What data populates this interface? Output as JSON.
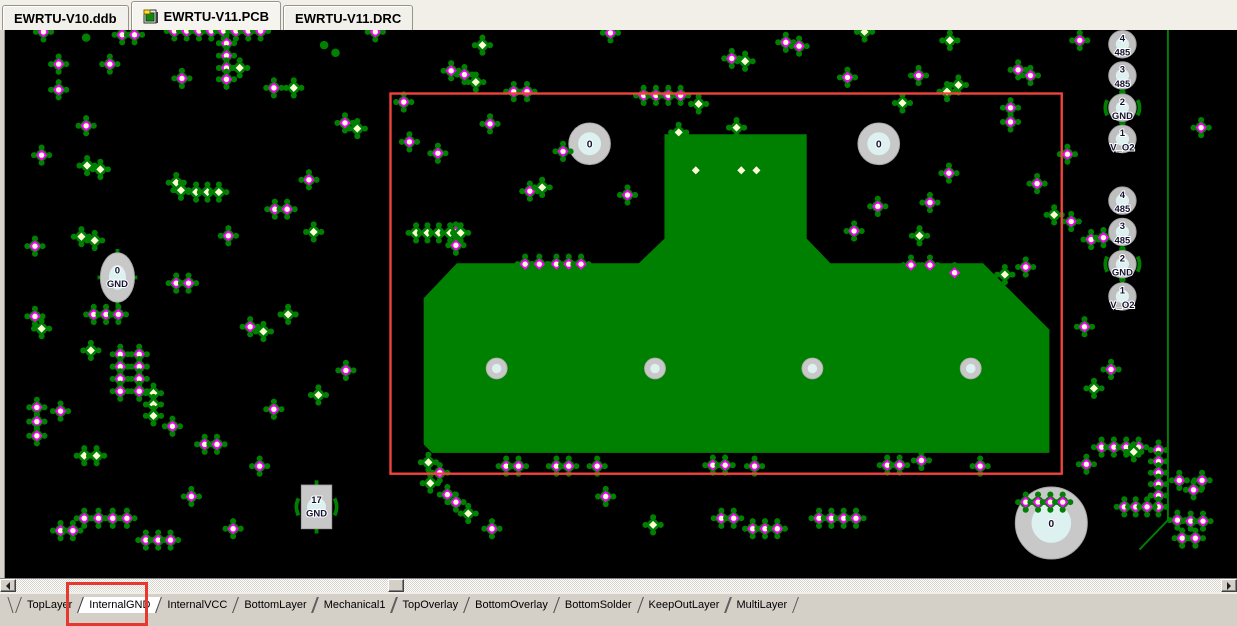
{
  "doc_tabs": {
    "tabs": [
      {
        "label": "EWRTU-V10.ddb",
        "active": false,
        "icon": false
      },
      {
        "label": "EWRTU-V11.PCB",
        "active": true,
        "icon": true
      },
      {
        "label": "EWRTU-V11.DRC",
        "active": false,
        "icon": false
      }
    ]
  },
  "canvas": {
    "colors": {
      "background": "#000000",
      "pad_green": "#008000",
      "polygon_green": "#008000",
      "via_magenta": "#FF00FF",
      "crosshair_magenta": "#B400B4",
      "pad_center_yellow": "#FFFFC2",
      "hole_ring_gray": "#C8C8C8",
      "hole_center_cyan": "#DDF1F1",
      "selection_red": "#F4423C",
      "label_text": "#141432"
    },
    "selection_rect": {
      "x": 378,
      "y": 97,
      "w": 708,
      "h": 401
    },
    "polygon_points": "667,140 817,140 817,250 842,276 1003,276 1073,346 1073,476 422,476 413,467 413,313 448,276 640,276 667,250",
    "board_outline_points": "1198,30 1198,547 1168,578",
    "mount_holes": [
      {
        "x": 588,
        "y": 150,
        "r": 22,
        "label": "0"
      },
      {
        "x": 893,
        "y": 150,
        "r": 22,
        "label": "0"
      },
      {
        "x": 1075,
        "y": 550,
        "r": 38,
        "label": "0"
      }
    ],
    "inner_holes": [
      {
        "x": 490,
        "y": 387
      },
      {
        "x": 657,
        "y": 387
      },
      {
        "x": 823,
        "y": 387
      },
      {
        "x": 990,
        "y": 387
      }
    ],
    "labeled_pads": [
      {
        "x": 90,
        "y": 291,
        "shape": "ellipse",
        "num": "0",
        "net": "GND"
      },
      {
        "x": 300,
        "y": 533,
        "shape": "rect",
        "num": "17",
        "net": "GND"
      }
    ],
    "connector_pads": [
      {
        "x": 1150,
        "y": 45,
        "num": "4",
        "net": "485",
        "thermal": false
      },
      {
        "x": 1150,
        "y": 78,
        "num": "3",
        "net": "485",
        "thermal": false
      },
      {
        "x": 1150,
        "y": 112,
        "num": "2",
        "net": "GND",
        "thermal": true
      },
      {
        "x": 1150,
        "y": 145,
        "num": "1",
        "net": "V_O2",
        "thermal": false
      },
      {
        "x": 1150,
        "y": 210,
        "num": "4",
        "net": "485",
        "thermal": false
      },
      {
        "x": 1150,
        "y": 243,
        "num": "3",
        "net": "485",
        "thermal": false
      },
      {
        "x": 1150,
        "y": 277,
        "num": "2",
        "net": "GND",
        "thermal": true
      },
      {
        "x": 1150,
        "y": 311,
        "num": "1",
        "net": "V_O2",
        "thermal": false
      }
    ],
    "tower_dots": [
      [
        700,
        178
      ],
      [
        748,
        178
      ],
      [
        764,
        178
      ]
    ],
    "pads": [
      [
        12,
        32,
        "v"
      ],
      [
        95,
        35,
        "v"
      ],
      [
        108,
        35,
        "v"
      ],
      [
        57,
        38,
        "t"
      ],
      [
        150,
        31,
        "v"
      ],
      [
        163,
        31,
        "v"
      ],
      [
        176,
        31,
        "v"
      ],
      [
        189,
        31,
        "v"
      ],
      [
        202,
        31,
        "v"
      ],
      [
        215,
        31,
        "v"
      ],
      [
        228,
        31,
        "v"
      ],
      [
        241,
        31,
        "v"
      ],
      [
        205,
        44,
        "v"
      ],
      [
        205,
        57,
        "v"
      ],
      [
        205,
        70,
        "v"
      ],
      [
        205,
        82,
        "v"
      ],
      [
        219,
        70,
        "p"
      ],
      [
        28,
        66,
        "v"
      ],
      [
        82,
        66,
        "v"
      ],
      [
        28,
        93,
        "v"
      ],
      [
        57,
        131,
        "v"
      ],
      [
        158,
        81,
        "v"
      ],
      [
        255,
        91,
        "v"
      ],
      [
        276,
        91,
        "p"
      ],
      [
        308,
        46,
        "t"
      ],
      [
        320,
        54,
        "t"
      ],
      [
        362,
        32,
        "v"
      ],
      [
        330,
        128,
        "v"
      ],
      [
        343,
        134,
        "p"
      ],
      [
        392,
        106,
        "v"
      ],
      [
        442,
        73,
        "v"
      ],
      [
        456,
        77,
        "v"
      ],
      [
        468,
        85,
        "p"
      ],
      [
        475,
        46,
        "p"
      ],
      [
        508,
        95,
        "v"
      ],
      [
        522,
        95,
        "v"
      ],
      [
        610,
        33,
        "v"
      ],
      [
        645,
        99,
        "v"
      ],
      [
        658,
        99,
        "v"
      ],
      [
        671,
        99,
        "v"
      ],
      [
        684,
        99,
        "v"
      ],
      [
        703,
        108,
        "p"
      ],
      [
        738,
        60,
        "v"
      ],
      [
        752,
        63,
        "p"
      ],
      [
        795,
        43,
        "v"
      ],
      [
        809,
        47,
        "v"
      ],
      [
        860,
        80,
        "v"
      ],
      [
        878,
        32,
        "p"
      ],
      [
        935,
        78,
        "v"
      ],
      [
        965,
        95,
        "p"
      ],
      [
        977,
        88,
        "p"
      ],
      [
        968,
        41,
        "p"
      ],
      [
        1040,
        72,
        "v"
      ],
      [
        1053,
        78,
        "v"
      ],
      [
        1105,
        41,
        "v"
      ],
      [
        1233,
        133,
        "v"
      ],
      [
        10,
        162,
        "v"
      ],
      [
        58,
        173,
        "p"
      ],
      [
        72,
        177,
        "p"
      ],
      [
        152,
        191,
        "p"
      ],
      [
        157,
        199,
        "p"
      ],
      [
        173,
        201,
        "p"
      ],
      [
        185,
        201,
        "p"
      ],
      [
        197,
        201,
        "p"
      ],
      [
        292,
        188,
        "v"
      ],
      [
        256,
        219,
        "v"
      ],
      [
        269,
        219,
        "v"
      ],
      [
        297,
        243,
        "p"
      ],
      [
        207,
        247,
        "v"
      ],
      [
        52,
        248,
        "p"
      ],
      [
        66,
        252,
        "p"
      ],
      [
        3,
        258,
        "v"
      ],
      [
        152,
        297,
        "v"
      ],
      [
        165,
        297,
        "v"
      ],
      [
        65,
        330,
        "v"
      ],
      [
        78,
        330,
        "v"
      ],
      [
        91,
        330,
        "v"
      ],
      [
        10,
        345,
        "p"
      ],
      [
        3,
        332,
        "v"
      ],
      [
        230,
        343,
        "v"
      ],
      [
        244,
        348,
        "p"
      ],
      [
        270,
        330,
        "p"
      ],
      [
        331,
        389,
        "v"
      ],
      [
        302,
        415,
        "p"
      ],
      [
        255,
        430,
        "v"
      ],
      [
        62,
        368,
        "p"
      ],
      [
        93,
        372,
        "v"
      ],
      [
        113,
        372,
        "v"
      ],
      [
        93,
        385,
        "v"
      ],
      [
        113,
        385,
        "v"
      ],
      [
        93,
        398,
        "v"
      ],
      [
        113,
        398,
        "v"
      ],
      [
        93,
        411,
        "v"
      ],
      [
        113,
        411,
        "v"
      ],
      [
        128,
        413,
        "p"
      ],
      [
        128,
        425,
        "p"
      ],
      [
        128,
        437,
        "p"
      ],
      [
        5,
        428,
        "v"
      ],
      [
        5,
        443,
        "v"
      ],
      [
        5,
        458,
        "v"
      ],
      [
        30,
        432,
        "v"
      ],
      [
        55,
        479,
        "p"
      ],
      [
        68,
        479,
        "p"
      ],
      [
        148,
        448,
        "v"
      ],
      [
        182,
        467,
        "v"
      ],
      [
        195,
        467,
        "v"
      ],
      [
        240,
        490,
        "v"
      ],
      [
        55,
        545,
        "v"
      ],
      [
        70,
        545,
        "v"
      ],
      [
        85,
        545,
        "v"
      ],
      [
        100,
        545,
        "v"
      ],
      [
        30,
        558,
        "v"
      ],
      [
        43,
        558,
        "v"
      ],
      [
        120,
        568,
        "v"
      ],
      [
        133,
        568,
        "v"
      ],
      [
        146,
        568,
        "v"
      ],
      [
        168,
        522,
        "v"
      ],
      [
        212,
        556,
        "v"
      ],
      [
        398,
        148,
        "v"
      ],
      [
        428,
        160,
        "v"
      ],
      [
        483,
        129,
        "v"
      ],
      [
        560,
        158,
        "v"
      ],
      [
        525,
        200,
        "v"
      ],
      [
        538,
        196,
        "p"
      ],
      [
        628,
        204,
        "v"
      ],
      [
        447,
        243,
        "v"
      ],
      [
        447,
        257,
        "v"
      ],
      [
        405,
        244,
        "p"
      ],
      [
        417,
        244,
        "p"
      ],
      [
        429,
        244,
        "p"
      ],
      [
        441,
        244,
        "p"
      ],
      [
        452,
        244,
        "p"
      ],
      [
        520,
        277,
        "v"
      ],
      [
        535,
        277,
        "v"
      ],
      [
        553,
        277,
        "v"
      ],
      [
        566,
        277,
        "v"
      ],
      [
        579,
        277,
        "v"
      ],
      [
        682,
        138,
        "p"
      ],
      [
        743,
        133,
        "p"
      ],
      [
        867,
        242,
        "v"
      ],
      [
        892,
        216,
        "v"
      ],
      [
        947,
        212,
        "v"
      ],
      [
        936,
        247,
        "p"
      ],
      [
        927,
        278,
        "v"
      ],
      [
        947,
        278,
        "v"
      ],
      [
        973,
        286,
        "v"
      ],
      [
        1026,
        288,
        "p"
      ],
      [
        1048,
        280,
        "v"
      ],
      [
        1032,
        112,
        "v"
      ],
      [
        1032,
        127,
        "v"
      ],
      [
        1060,
        192,
        "v"
      ],
      [
        1092,
        161,
        "v"
      ],
      [
        1078,
        225,
        "p"
      ],
      [
        1096,
        232,
        "v"
      ],
      [
        918,
        107,
        "p"
      ],
      [
        967,
        181,
        "v"
      ],
      [
        1117,
        251,
        "v"
      ],
      [
        1130,
        249,
        "v"
      ],
      [
        418,
        486,
        "p"
      ],
      [
        430,
        497,
        "v"
      ],
      [
        420,
        508,
        "p"
      ],
      [
        438,
        520,
        "v"
      ],
      [
        447,
        528,
        "v"
      ],
      [
        460,
        540,
        "p"
      ],
      [
        485,
        556,
        "v"
      ],
      [
        500,
        490,
        "v"
      ],
      [
        513,
        490,
        "v"
      ],
      [
        553,
        490,
        "v"
      ],
      [
        566,
        490,
        "v"
      ],
      [
        596,
        490,
        "v"
      ],
      [
        605,
        522,
        "v"
      ],
      [
        655,
        552,
        "p"
      ],
      [
        718,
        489,
        "v"
      ],
      [
        731,
        489,
        "v"
      ],
      [
        762,
        490,
        "v"
      ],
      [
        727,
        545,
        "v"
      ],
      [
        740,
        545,
        "v"
      ],
      [
        760,
        556,
        "v"
      ],
      [
        773,
        556,
        "v"
      ],
      [
        786,
        556,
        "v"
      ],
      [
        830,
        545,
        "v"
      ],
      [
        843,
        545,
        "v"
      ],
      [
        856,
        545,
        "v"
      ],
      [
        869,
        545,
        "v"
      ],
      [
        902,
        489,
        "v"
      ],
      [
        915,
        489,
        "v"
      ],
      [
        938,
        484,
        "v"
      ],
      [
        1000,
        490,
        "v"
      ],
      [
        1048,
        528,
        "v"
      ],
      [
        1061,
        528,
        "v"
      ],
      [
        1074,
        528,
        "v"
      ],
      [
        1087,
        528,
        "v"
      ],
      [
        1112,
        488,
        "v"
      ],
      [
        1110,
        343,
        "v"
      ],
      [
        1138,
        388,
        "v"
      ],
      [
        1120,
        408,
        "p"
      ],
      [
        1128,
        470,
        "v"
      ],
      [
        1141,
        470,
        "v"
      ],
      [
        1154,
        470,
        "v"
      ],
      [
        1167,
        470,
        "v"
      ],
      [
        1188,
        473,
        "v"
      ],
      [
        1188,
        485,
        "v"
      ],
      [
        1188,
        497,
        "v"
      ],
      [
        1188,
        509,
        "v"
      ],
      [
        1188,
        521,
        "v"
      ],
      [
        1188,
        533,
        "v"
      ],
      [
        1152,
        533,
        "v"
      ],
      [
        1164,
        533,
        "v"
      ],
      [
        1176,
        533,
        "v"
      ],
      [
        1162,
        475,
        "p"
      ],
      [
        1210,
        505,
        "v"
      ],
      [
        1225,
        515,
        "v"
      ],
      [
        1234,
        505,
        "v"
      ],
      [
        1208,
        547,
        "v"
      ],
      [
        1222,
        548,
        "v"
      ],
      [
        1235,
        548,
        "v"
      ],
      [
        1213,
        566,
        "v"
      ],
      [
        1227,
        566,
        "v"
      ]
    ]
  },
  "scrollbar": {
    "thumb_x": 388
  },
  "layer_tabs": {
    "tabs": [
      {
        "label": "TopLayer",
        "active": false
      },
      {
        "label": "InternalGND",
        "active": true
      },
      {
        "label": "InternalVCC",
        "active": false
      },
      {
        "label": "BottomLayer",
        "active": false
      },
      {
        "label": "Mechanical1",
        "active": false
      },
      {
        "label": "TopOverlay",
        "active": false
      },
      {
        "label": "BottomOverlay",
        "active": false
      },
      {
        "label": "BottomSolder",
        "active": false
      },
      {
        "label": "KeepOutLayer",
        "active": false
      },
      {
        "label": "MultiLayer",
        "active": false
      }
    ]
  },
  "annotation": {
    "color": "#E8372F",
    "tab_box": {
      "left": 66,
      "top": 582,
      "width": 76,
      "height": 38
    }
  }
}
